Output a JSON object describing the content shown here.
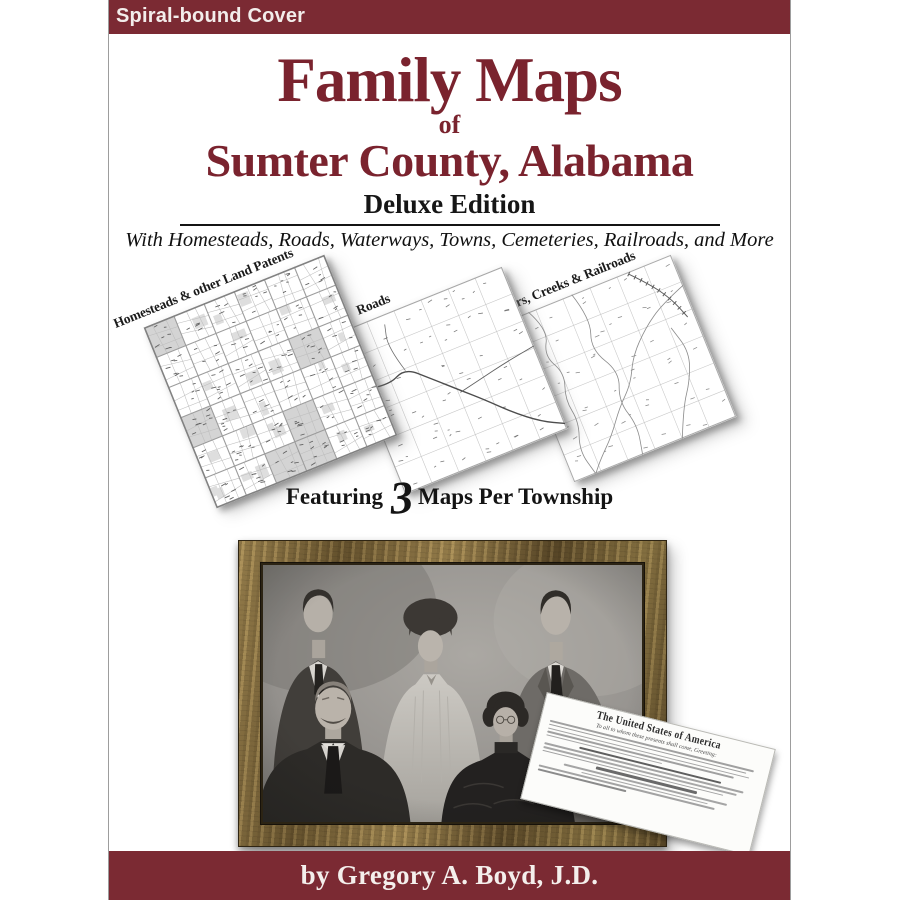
{
  "badge": {
    "label": "Spiral-bound Cover"
  },
  "title": {
    "line1": "Family Maps",
    "connector": "of",
    "line2": "Sumter County, Alabama",
    "edition": "Deluxe Edition",
    "tagline": "With Homesteads, Roads, Waterways, Towns, Cemeteries, Railroads, and More"
  },
  "maps": {
    "items": [
      {
        "label": "Homesteads & other Land Patents",
        "type": "patents"
      },
      {
        "label": "Roads",
        "type": "roads"
      },
      {
        "label": "Rivers, Creeks & Railroads",
        "type": "rivers"
      }
    ],
    "caption": {
      "prefix": "Featuring",
      "number": "3",
      "suffix": "Maps Per Township"
    }
  },
  "patent_document": {
    "header": "The United States of America",
    "subheader": "To all to whom these presents shall come, Greeting:"
  },
  "footer": {
    "byline": "by Gregory A. Boyd, J.D."
  },
  "colors": {
    "band_maroon": "#7b2a33",
    "title_maroon": "#7a232e",
    "frame_gold_dark": "#5e4c2c",
    "frame_gold_light": "#a98f58"
  }
}
